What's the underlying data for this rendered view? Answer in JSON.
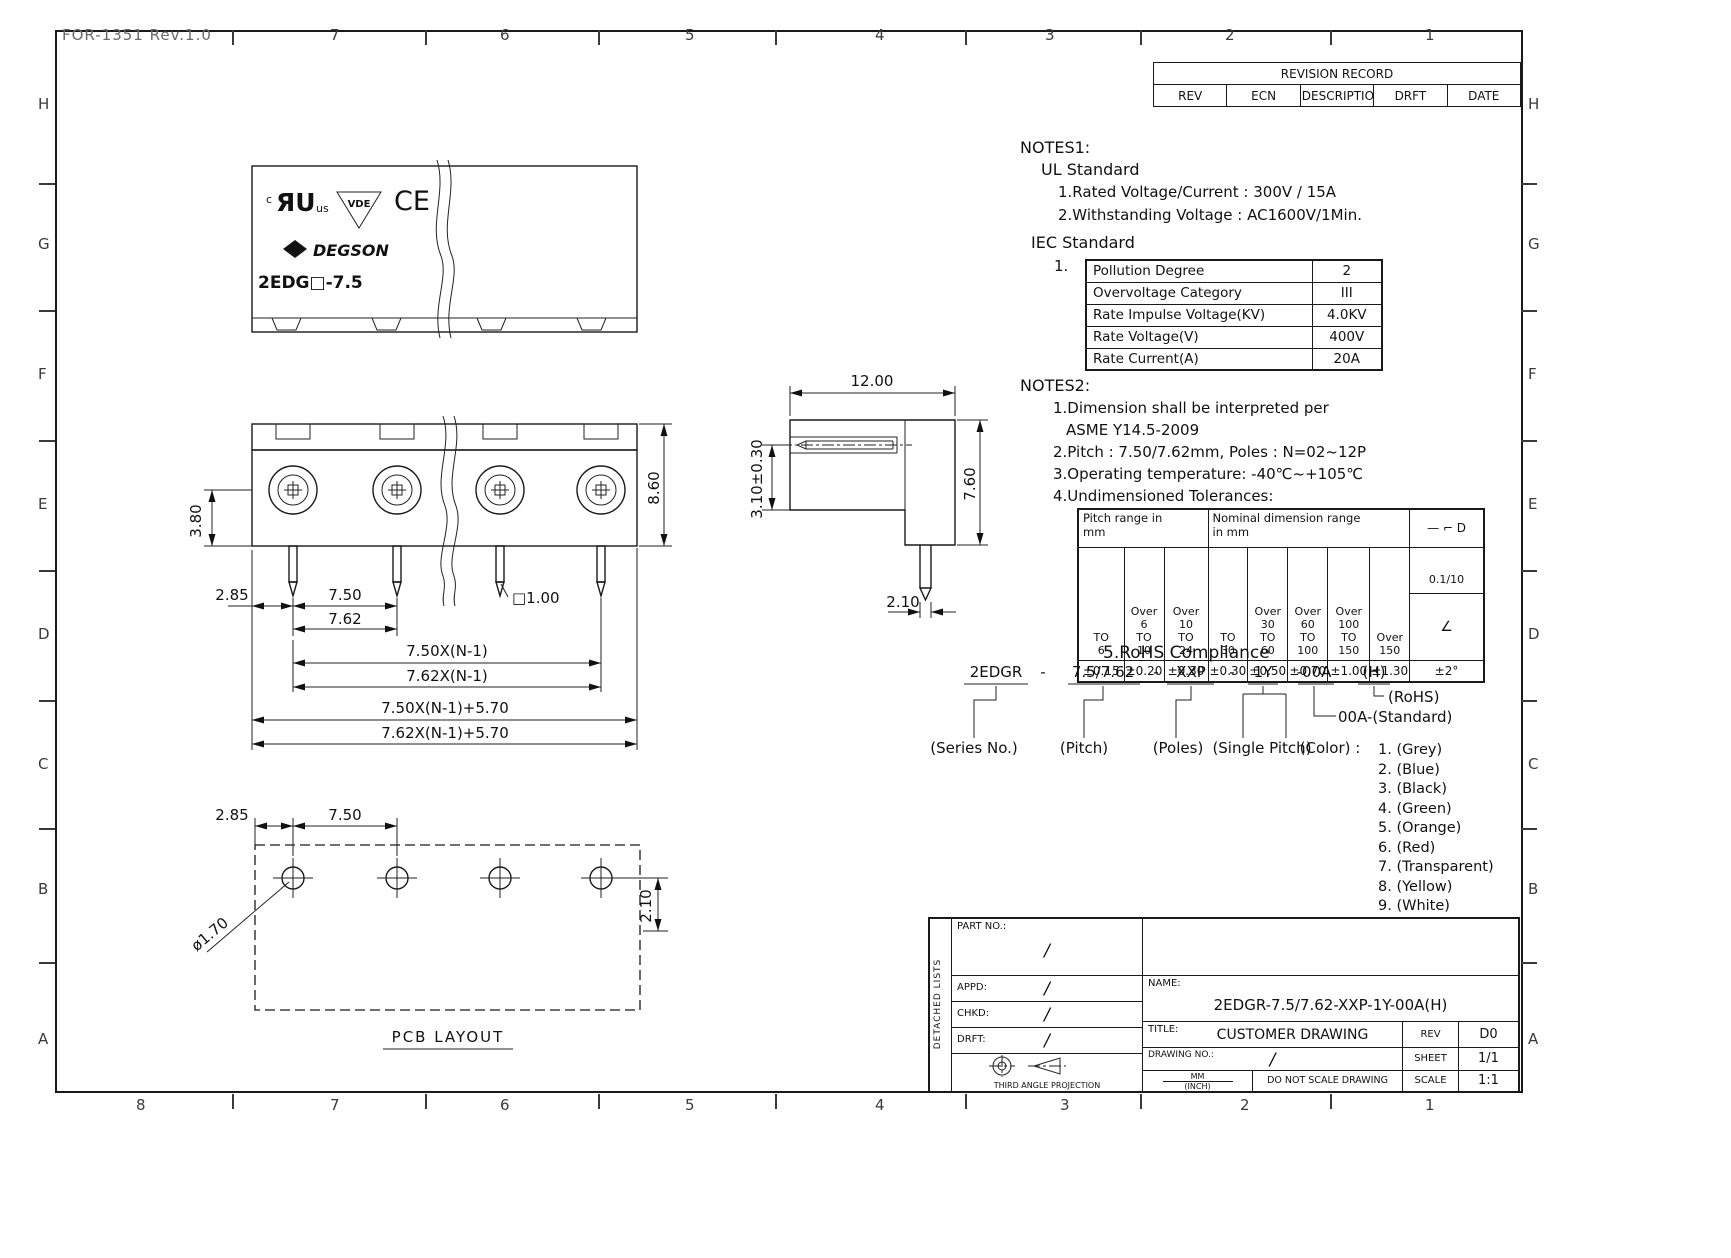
{
  "frame": {
    "doc_ref": "FOR-1351  Rev.1.0",
    "cols_top": [
      "7",
      "6",
      "5",
      "4",
      "3",
      "2",
      "1"
    ],
    "cols_bottom": [
      "8",
      "7",
      "6",
      "5",
      "4",
      "3",
      "2",
      "1"
    ],
    "rows_left": [
      "H",
      "G",
      "F",
      "E",
      "D",
      "C",
      "B",
      "A"
    ],
    "rows_right": [
      "H",
      "G",
      "F",
      "E",
      "D",
      "C",
      "B",
      "A"
    ]
  },
  "revision_table": {
    "title": "REVISION RECORD",
    "col_rev": "REV",
    "col_ecn": "ECN",
    "col_desc": "DESCRIPTION",
    "col_drft": "DRFT",
    "col_date": "DATE"
  },
  "logos": {
    "ul_prefix": "c",
    "ul_mark": "ЯU",
    "ul_suffix": "us",
    "vde": "VDE",
    "ce": "CE",
    "brand": "DEGSON",
    "model": "2EDG□-7.5"
  },
  "notes1": {
    "heading": "NOTES1:",
    "ul_heading": "UL Standard",
    "ul_item1": "1.Rated Voltage/Current : 300V / 15A",
    "ul_item2": "2.Withstanding Voltage : AC1600V/1Min.",
    "iec_heading": "IEC Standard",
    "iec_index": "1.",
    "iec_rows": [
      {
        "label": "Pollution Degree",
        "value": "2"
      },
      {
        "label": "Overvoltage Category",
        "value": "III"
      },
      {
        "label": "Rate Impulse Voltage(KV)",
        "value": "4.0KV"
      },
      {
        "label": "Rate Voltage(V)",
        "value": "400V"
      },
      {
        "label": "Rate Current(A)",
        "value": "20A"
      }
    ]
  },
  "notes2": {
    "heading": "NOTES2:",
    "item1": "1.Dimension shall be interpreted per",
    "item1b": "ASME Y14.5-2009",
    "item2": "2.Pitch : 7.50/7.62mm, Poles : N=02~12P",
    "item3": "3.Operating temperature: -40℃~+105℃",
    "item4": "4.Undimensioned Tolerances:"
  },
  "tolerance_table": {
    "group_pitch": "Pitch range in\nmm",
    "group_nominal": "Nominal dimension range\nin mm",
    "sym_header": "—  ⌐  D",
    "h1": "TO\n6",
    "h2": "Over\n6\nTO\n10",
    "h3": "Over\n10\nTO\n24",
    "h4": "TO\n30",
    "h5": "Over\n30\nTO\n60",
    "h6": "Over\n60\nTO\n100",
    "h7": "Over\n100\nTO\n150",
    "h8": "Over\n150",
    "flat": "0.1/10",
    "angle_sym": "∠",
    "v1": "±0.15",
    "v2": "±0.20",
    "v3": "±0.30",
    "v4": "±0.30",
    "v5": "±0.50",
    "v6": "±0.70",
    "v7": "±1.00",
    "v8": "±1.30",
    "v9": "±2°"
  },
  "rohs_heading": "5.RoHS Compliance",
  "part_number": {
    "s1": "2EDGR",
    "d1": "-",
    "s2": "7.5/7.62",
    "d2": "-",
    "s3": "XXP",
    "d3": "-",
    "s4": "1Y",
    "s5": "-00A",
    "s6": "(H)",
    "rohs": "(RoHS)",
    "standard": "00A-(Standard)",
    "series": "(Series No.)",
    "pitch": "(Pitch)",
    "poles": "(Poles)",
    "single_pitch": "(Single Pitch)",
    "color": "(Color) :",
    "colors": [
      "1. (Grey)",
      "2. (Blue)",
      "3. (Black)",
      "4. (Green)",
      "5. (Orange)",
      "6. (Red)",
      "7. (Transparent)",
      "8. (Yellow)",
      "9. (White)"
    ]
  },
  "front_view": {
    "dim_285": "2.85",
    "dim_750": "7.50",
    "dim_762": "7.62",
    "dim_380": "3.80",
    "dim_860": "8.60",
    "dim_sq": "□1.00",
    "dim_n1": "7.50X(N-1)",
    "dim_n2": "7.62X(N-1)",
    "dim_n3": "7.50X(N-1)+5.70",
    "dim_n4": "7.62X(N-1)+5.70"
  },
  "side_view": {
    "dim_1200": "12.00",
    "dim_310": "3.10±0.30",
    "dim_760": "7.60",
    "dim_210": "2.10"
  },
  "pcb": {
    "dim_285": "2.85",
    "dim_750": "7.50",
    "dim_170": "ø1.70",
    "dim_210": "2.10",
    "label": "PCB LAYOUT"
  },
  "title_block": {
    "detached": "DETACHED LISTS",
    "part_no": "PART NO.:",
    "appd": "APPD:",
    "chkd": "CHKD:",
    "drft": "DRFT:",
    "slash": "/",
    "name_label": "NAME:",
    "name_value": "2EDGR-7.5/7.62-XXP-1Y-00A(H)",
    "title_label": "TITLE:",
    "title_value": "CUSTOMER DRAWING",
    "rev_label": "REV",
    "rev_value": "D0",
    "drawing_no_label": "DRAWING NO.:",
    "sheet_label": "SHEET",
    "sheet_value": "1/1",
    "units_mm": "MM",
    "units_inch": "(INCH)",
    "no_scale": "DO NOT SCALE DRAWING",
    "scale_label": "SCALE",
    "scale_value": "1:1",
    "projection": "THIRD ANGLE PROJECTION"
  }
}
